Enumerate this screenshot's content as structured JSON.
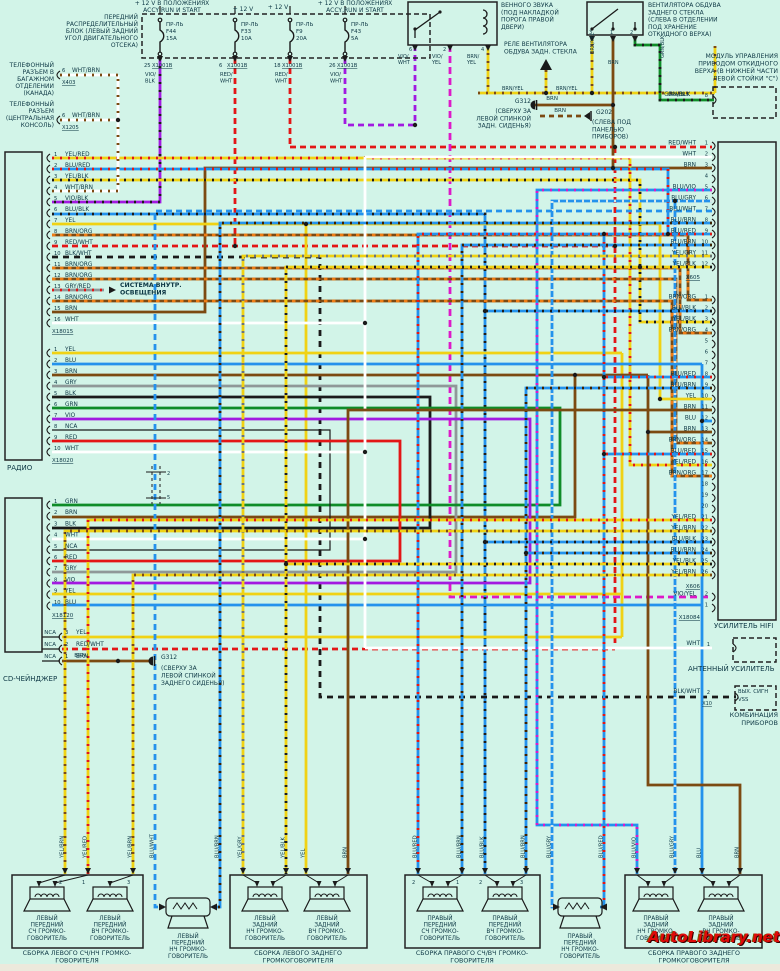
{
  "watermark": "AutoLibrary.net",
  "colors": {
    "background": "#d2f4e8",
    "yellow": "#f0d214",
    "red": "#e31616",
    "blue": "#2492ec",
    "brown": "#7c4a12",
    "green": "#0f8c28",
    "violet": "#a21ae0",
    "gray": "#8f9898",
    "black": "#1a1a1a",
    "white": "#ffffff",
    "orange": "#f07d14",
    "magenta": "#dd18c8",
    "text": "#0d3744"
  },
  "feeds": [
    {
      "label": "+ 12 V В ПОЛОЖЕНИЯХ\nACCY,RUN И START"
    },
    {
      "label": "+ 12 V"
    },
    {
      "label": "+ 12 V"
    },
    {
      "label": "+ 12 V В ПОЛОЖЕНИЯХ\nACCY,RUN И START"
    }
  ],
  "fuse_panel": {
    "label": "ПЕРЕДНИЙ\nРАСПРЕДЕЛИТЕЛЬНЫЙ\nБЛОК (ЛЕВЫЙ ЗАДНИЙ\nУГОЛ ДВИГАТЕЛЬНОГО\nОТСЕКА)",
    "fuses": [
      {
        "name": "ПР-ЛЬ",
        "id": "F44",
        "amps": "15A",
        "pin": "25",
        "conn": "X1001B",
        "wire": "VIO/\nBLK"
      },
      {
        "name": "ПР-ЛЬ",
        "id": "F33",
        "amps": "10A",
        "pin": "6",
        "conn": "X1001B",
        "wire": "RED/\nWHT"
      },
      {
        "name": "ПР-ЛЬ",
        "id": "F9",
        "amps": "20A",
        "pin": "18",
        "conn": "X1001B",
        "wire": "RED/\nWHT"
      },
      {
        "name": "ПР-ЛЬ",
        "id": "F43",
        "amps": "5A",
        "pin": "26",
        "conn": "X1001B",
        "wire": "VIO/\nWHT"
      }
    ]
  },
  "phones": [
    {
      "label": "ТЕЛЕФОННЫЙ\nРАЗЪЕМ В\nБАГАЖНОМ\nОТДЕЛЕНИИ\n(КАНАДА)",
      "pin": "6",
      "wire": "WHT/BRN",
      "conn": "X403"
    },
    {
      "label": "ТЕЛЕФОННЫЙ\nРАЗЪЕМ\n(ЦЕНТРАЛЬНАЯ\nКОНСОЛЬ)",
      "pin": "6",
      "wire": "WHT/BRN",
      "conn": "X1205"
    }
  ],
  "relay_horn": {
    "label": "ВЕННОГО ЗВУКА\n(ПОД НАКЛАДКОЙ\nПОРОГА ПРАВОЙ\nДВЕРИ)",
    "pins": [
      {
        "num": "6",
        "wire": "VIO/\nWHT"
      },
      {
        "num": "2",
        "wire": "VIO/\nYEL"
      },
      {
        "num": "4",
        "wire": "BRN/\nYEL"
      }
    ]
  },
  "relay_fan": {
    "label": "РЕЛЕ ВЕНТИЛЯТОРА\nОБДУВА ЗАДН. СТЕКЛА"
  },
  "motor": {
    "label": "ВЕНТИЛЯТОРА ОБДУВА\nЗАДНЕГО СТЕКЛА\n(СЛЕВА В ОТДЕЛЕНИИ\nПОД ХРАНЕНИЕ\nОТКИДНОГО ВЕРХА)",
    "pins": [
      {
        "num": "3",
        "wire": "BRN/YEL"
      },
      {
        "num": "1",
        "wire": "BRN"
      },
      {
        "num": "2",
        "wire": "GRN/BLK"
      }
    ]
  },
  "module": {
    "label": "МОДУЛЬ УПРАВЛЕНИЯ\nПРИВОДОМ ОТКИДНОГО\nВЕРХА (В НИЖНЕЙ ЧАСТИ\nЛЕВОЙ СТОЙКИ \"С\")",
    "pin": "8",
    "wire": "GRN/BLK"
  },
  "g312_top": {
    "id": "G312",
    "wire": "BRN",
    "note": "(СВЕРХУ ЗА\nЛЕВОЙ СПИНКОЙ\nЗАДН. СИДЕНЬЯ)"
  },
  "g202": {
    "id": "G202",
    "wire": "BRN",
    "note": "(СЛЕВА ПОД\nПАНЕЛЬЮ\nПРИБОРОВ)"
  },
  "g312_bottom": {
    "id": "G312",
    "wire": "BRN",
    "note": "(СВЕРХУ ЗА\nЛЕВОЙ СПИНКОЙ\nЗАДНЕГО СИДЕНЬЯ)"
  },
  "lighting_note": "СИСТЕМА ВНУТР.\nОСВЕЩЕНИЯ",
  "radio": {
    "label": "РАДИО",
    "conn1": {
      "id": "X18015",
      "pins": [
        "YEL/RED",
        "BLU/RED",
        "YEL/BLK",
        "WHT/BRN",
        "VIO/BLK",
        "BLU/BLK",
        "YEL",
        "BRN/ORG",
        "RED/WHT",
        "BLK/WHT",
        "BRN/ORG",
        "BRN/ORG",
        "GRY/RED",
        "BRN/ORG",
        "BRN",
        "WHT"
      ]
    },
    "conn2": {
      "id": "X18020",
      "pins": [
        "YEL",
        "BLU",
        "BRN",
        "GRY",
        "BLK",
        "GRN",
        "VIO",
        "NCA",
        "RED",
        "WHT"
      ]
    }
  },
  "cd": {
    "label": "CD-ЧЕЙНДЖЕР",
    "conn": {
      "id": "X18120",
      "pins": [
        "GRN",
        "BRN",
        "BLK",
        "WHT",
        "NCA",
        "RED",
        "GRY",
        "VIO",
        "YEL",
        "BLU"
      ]
    },
    "nca_label": "NCA",
    "nca": [
      {
        "pin": "3",
        "wire": "YEL"
      },
      {
        "pin": "2",
        "wire": "RED/WHT"
      },
      {
        "pin": "1",
        "wire": "BRN"
      }
    ]
  },
  "amp": {
    "label": "УСИЛИТЕЛЬ HIFI",
    "conn1": {
      "id": "X605",
      "pins": [
        "RED/WHT",
        "WHT",
        "BRN",
        "",
        "BLU/VIO",
        "BLU/GRY",
        "BLU/WHT",
        "BLU/BRN",
        "BLU/RED",
        "BLU/BRN",
        "YEL/GRY",
        "YEL/BLK"
      ]
    },
    "conn2": {
      "id": "X606",
      "pins": [
        "BRN/ORG",
        "BLU/BLK",
        "YEL/BLK",
        "BRN/ORG",
        "",
        "",
        "",
        "BLU/RED",
        "BLU/BRN",
        "YEL",
        "BRN",
        "BLU",
        "BRN",
        "BRN/ORG",
        "BLU/RED",
        "YEL/RED",
        "BRN/ORG",
        "",
        "",
        "",
        "YEL/RED",
        "YEL/BRN",
        "BLU/BLK",
        "BLU/BRN",
        "YEL/BLK",
        "YEL/BRN"
      ]
    },
    "conn3": {
      "id": "X18084",
      "pins": [
        {
          "num": "2",
          "wire": "VIO/YEL"
        },
        {
          "num": "1",
          "wire": ""
        }
      ]
    }
  },
  "antenna": {
    "label": "АНТЕННЫЙ УСИЛИТЕЛЬ",
    "pin": "1",
    "wire": "WHT"
  },
  "cluster": {
    "label_line1": "КОМБИНАЦИЯ",
    "label_line2": "ПРИБОРОВ",
    "box": "ВЫХ. СИГН\nVSS",
    "pin": "2",
    "wire": "BLK/WHT",
    "conn": "X10"
  },
  "speakers": {
    "boxes": [
      {
        "label": "СБОРКА ЛЕВОГО СЧ/НЧ ГРОМКО-\nГОВОРИТЕЛЯ",
        "speakers": [
          "ЛЕВЫЙ\nПЕРЕДНИЙ\nСЧ ГРОМКО-\nГОВОРИТЕЛЬ",
          "ЛЕВЫЙ\nПЕРЕДНИЙ\nВЧ ГРОМКО-\nГОВОРИТЕЛЬ"
        ],
        "pins": [
          "2",
          "1",
          "3"
        ]
      },
      {
        "label": "СБОРКА ЛЕВОГО ЗАДНЕГО\nГРОМКОГОВОРИТЕЛЯ",
        "speakers": [
          "ЛЕВЫЙ\nЗАДНИЙ\nНЧ ГРОМКО-\nГОВОРИТЕЛЬ",
          "ЛЕВЫЙ\nЗАДНИЙ\nВЧ ГРОМКО-\nГОВОРИТЕЛЬ"
        ],
        "pins": []
      },
      {
        "label": "СБОРКА ПРАВОГО СЧ/ВЧ ГРОМКО-\nГОВОРИТЕЛЯ",
        "speakers": [
          "ПРАВЫЙ\nПЕРЕДНИЙ\nСЧ ГРОМКО-\nГОВОРИТЕЛЬ",
          "ПРАВЫЙ\nПЕРЕДНИЙ\nВЧ ГРОМКО-\nГОВОРИТЕЛЬ"
        ],
        "pins": [
          "2",
          "1",
          "2",
          "3"
        ]
      },
      {
        "label": "СБОРКА ПРАВОГО ЗАДНЕГО\nГРОМКОГОВОРИТЕЛЯ",
        "speakers": [
          "ПРАВЫЙ\nЗАДНИЙ\nНЧ ГРОМКО-\nГОВОРИТЕЛЬ",
          "ПРАВЫЙ\nЗАДНИЙ\nВЧ ГРОМКО-\nГОВОРИТЕЛЬ"
        ],
        "pins": []
      }
    ],
    "subs": [
      "ЛЕВЫЙ\nПЕРЕДНИЙ\nНЧ ГРОМКО-\nГОВОРИТЕЛЬ",
      "ПРАВЫЙ\nПЕРЕДНИЙ\nНЧ ГРОМКО-\nГОВОРИТЕЛЬ"
    ]
  },
  "bottom_wire_labels": {
    "left": [
      "YEL/BRN",
      "YEL/RED",
      "YEL/BRN",
      "BLU/WHT",
      "BLU/BRN",
      "YEL/GRY",
      "YEL/BLK",
      "YEL",
      "BRN"
    ],
    "right": [
      "BLU/RED",
      "BLU/BRN",
      "BLU/BLK",
      "BLU/BRN",
      "BLU/GRY",
      "BLU/RED",
      "BLU/VIO",
      "BLU/GRY",
      "BLU",
      "BRN"
    ]
  },
  "shield_pins": [
    "2",
    "5"
  ]
}
